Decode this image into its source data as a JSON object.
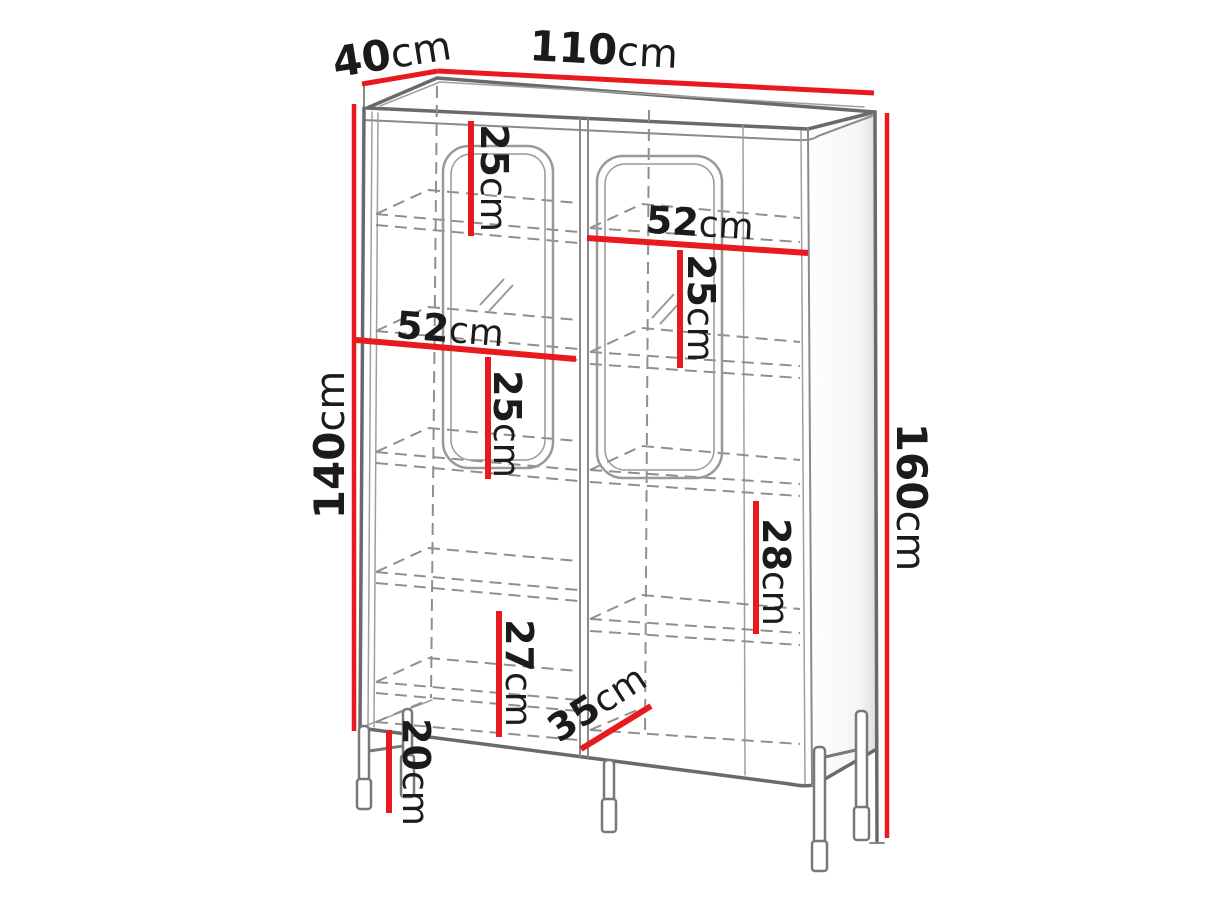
{
  "dimensions": {
    "depth": {
      "value": "40",
      "unit": "cm"
    },
    "width": {
      "value": "110",
      "unit": "cm"
    },
    "body_height": {
      "value": "140",
      "unit": "cm"
    },
    "total_height": {
      "value": "160",
      "unit": "cm"
    },
    "upper_left_compartment_height": {
      "value": "25",
      "unit": "cm"
    },
    "right_section_width": {
      "value": "52",
      "unit": "cm"
    },
    "right_compartment_height": {
      "value": "25",
      "unit": "cm"
    },
    "left_section_width": {
      "value": "52",
      "unit": "cm"
    },
    "left_compartment_height": {
      "value": "25",
      "unit": "cm"
    },
    "lower_right_compartment_height": {
      "value": "28",
      "unit": "cm"
    },
    "lower_left_compartment_height": {
      "value": "27",
      "unit": "cm"
    },
    "interior_depth": {
      "value": "35",
      "unit": "cm"
    },
    "leg_height": {
      "value": "20",
      "unit": "cm"
    }
  },
  "colors": {
    "dimension_line": "#e8191f",
    "outline_dark": "#6a6a6a",
    "outline_light": "#9f9f9f",
    "label_text": "#1b1b1b",
    "background": "#ffffff"
  }
}
